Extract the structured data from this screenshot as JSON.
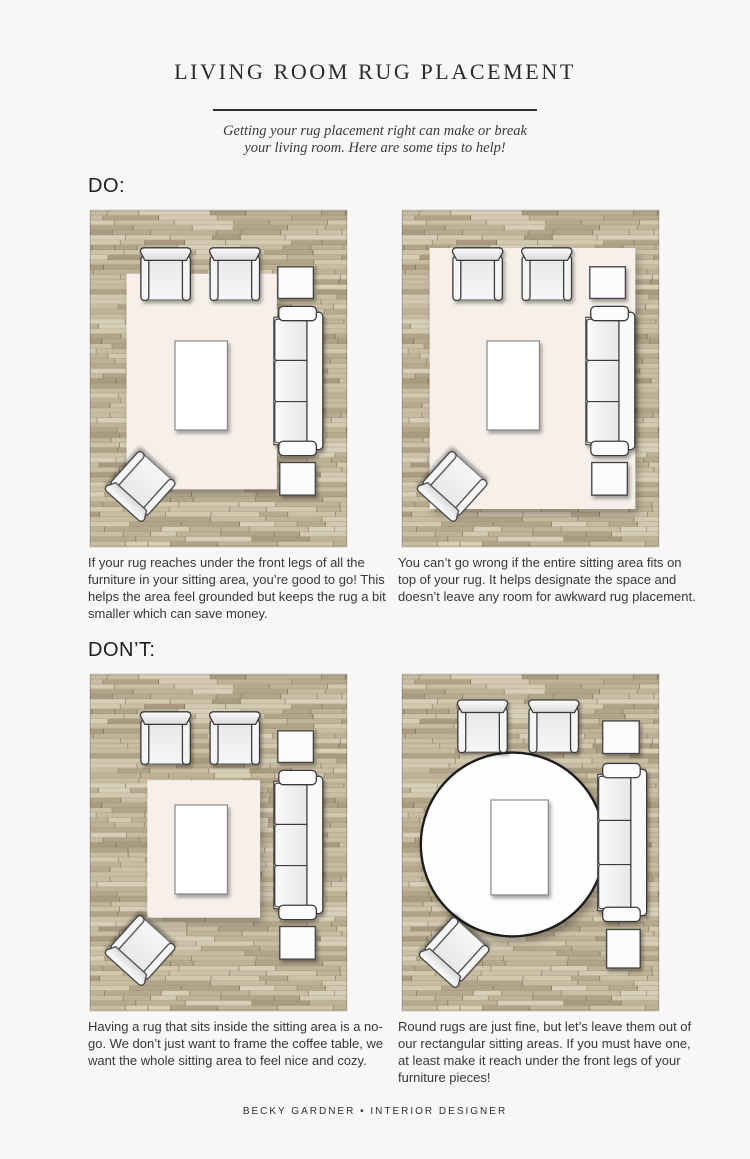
{
  "header": {
    "title": "LIVING ROOM RUG PLACEMENT",
    "subtitle": [
      "Getting your rug placement right can make or break",
      "your living room. Here are some tips to help!"
    ]
  },
  "sections": [
    {
      "label": "DO:",
      "items": [
        {
          "caption": "If your rug reaches under the front legs of all the furniture in your sitting area, you’re good to go! This helps the area feel grounded but keeps the rug a bit smaller which can save money.",
          "rug": {
            "shape": "rectangle",
            "placement": "under-front-legs"
          },
          "furniture": [
            "armchair",
            "armchair",
            "side-table",
            "sofa",
            "side-table",
            "coffee-table",
            "accent-chair"
          ]
        },
        {
          "caption": "You can’t go wrong if the entire sitting area fits on top of your rug. It helps designate the space and doesn’t leave any room for awkward rug placement.",
          "rug": {
            "shape": "rectangle",
            "placement": "entire-sitting-area-on-rug"
          },
          "furniture": [
            "armchair",
            "armchair",
            "side-table",
            "sofa",
            "side-table",
            "coffee-table",
            "accent-chair"
          ]
        }
      ]
    },
    {
      "label": "DON’T:",
      "items": [
        {
          "caption": "Having a rug that sits inside the sitting area is a no-go. We don’t just want to frame the coffee table, we want the whole sitting area to feel nice and cozy.",
          "rug": {
            "shape": "rectangle",
            "placement": "inside-sitting-area"
          },
          "furniture": [
            "armchair",
            "armchair",
            "side-table",
            "sofa",
            "side-table",
            "coffee-table",
            "accent-chair"
          ]
        },
        {
          "caption": "Round rugs are just fine, but let’s leave them out of our rectangular sitting areas. If you must have one, at least make it reach under the front legs of your furniture pieces!",
          "rug": {
            "shape": "circle",
            "placement": "round-centered-not-reaching-furniture"
          },
          "furniture": [
            "armchair",
            "armchair",
            "side-table",
            "sofa",
            "side-table",
            "coffee-table",
            "accent-chair"
          ]
        }
      ]
    }
  ],
  "footer": {
    "credit": "BECKY GARDNER • INTERIOR DESIGNER"
  },
  "colors": {
    "page_background": "#f8f7f6",
    "rug_cream": "#f7f0ea",
    "rug_round_white": "#fdfdfd",
    "wood_mid": "#bcae92",
    "text_dark": "#2b2b2b",
    "outline_dark": "#3a3a3a"
  }
}
